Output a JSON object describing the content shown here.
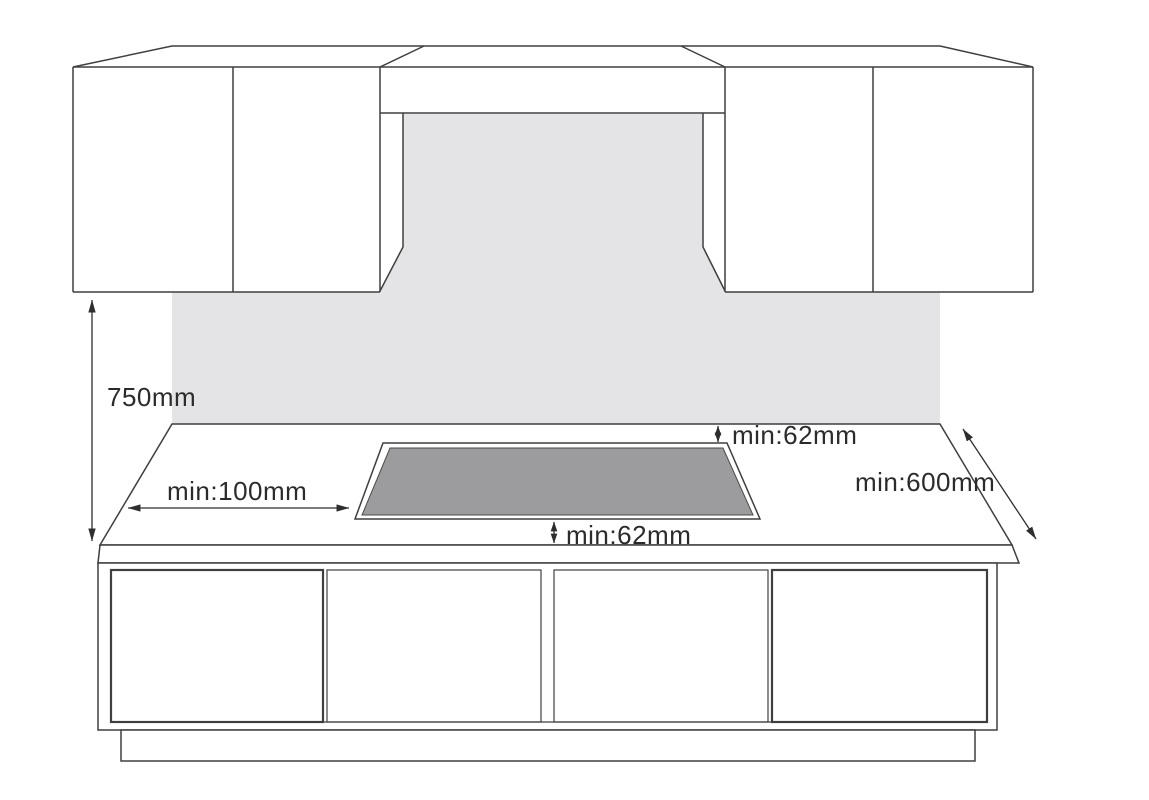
{
  "figure": {
    "kind": "installation-clearance-diagram",
    "subject": "built-in hob between wall cabinets, cooker hood and base cabinets"
  },
  "colors": {
    "background": "#ffffff",
    "line": "#3f3f3f",
    "backsplash_wall": "#e4e4e6",
    "hob_surface": "#9c9c9e",
    "hob_rim": "#fafafa",
    "label_text": "#2b2b2b"
  },
  "dimensions": {
    "cabinet_to_counter": {
      "label": "750mm"
    },
    "hob_to_left_edge": {
      "label": "min:100mm"
    },
    "hob_to_back": {
      "label": "min:62mm"
    },
    "hob_to_front": {
      "label": "min:62mm"
    },
    "counter_depth": {
      "label": "min:600mm"
    }
  }
}
